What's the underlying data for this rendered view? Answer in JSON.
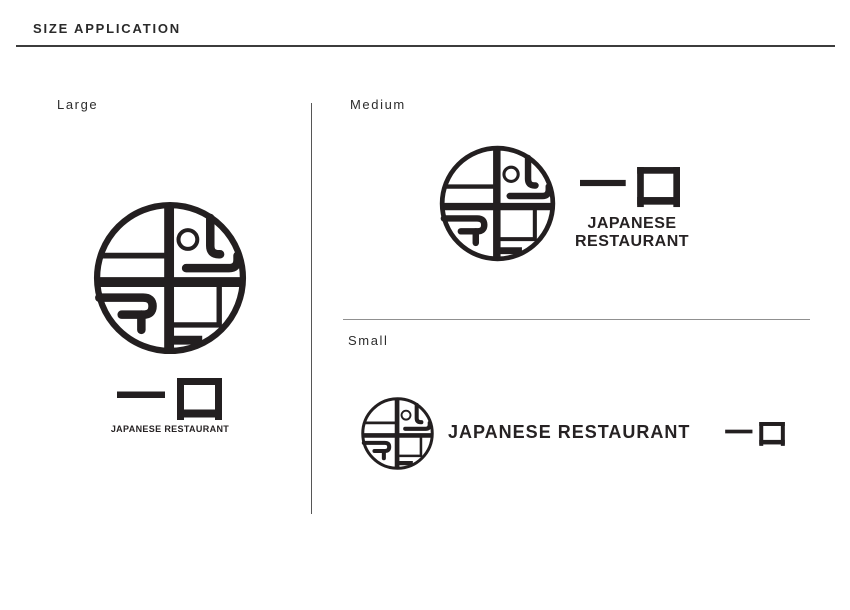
{
  "page": {
    "title": "SIZE APPLICATION",
    "background": "#ffffff",
    "ink_color": "#231f20",
    "top_rule_color": "#3c3c3c",
    "divider_color": "#909090"
  },
  "brand": {
    "logo_icon": "bento-circle-logo-icon",
    "kanji_mark_icon": "hitokuchi-kanji-mark-icon",
    "kanji_mark": "一口",
    "wordmark": "JAPANESE RESTAURANT"
  },
  "sections": {
    "large": {
      "label": "Large",
      "tagline": "JAPANESE RESTAURANT",
      "kanji": "一口"
    },
    "medium": {
      "label": "Medium",
      "tagline_line1": "JAPANESE",
      "tagline_line2": "RESTAURANT",
      "kanji": "一口"
    },
    "small": {
      "label": "Small",
      "tagline": "JAPANESE RESTAURANT",
      "kanji": "一口"
    }
  }
}
